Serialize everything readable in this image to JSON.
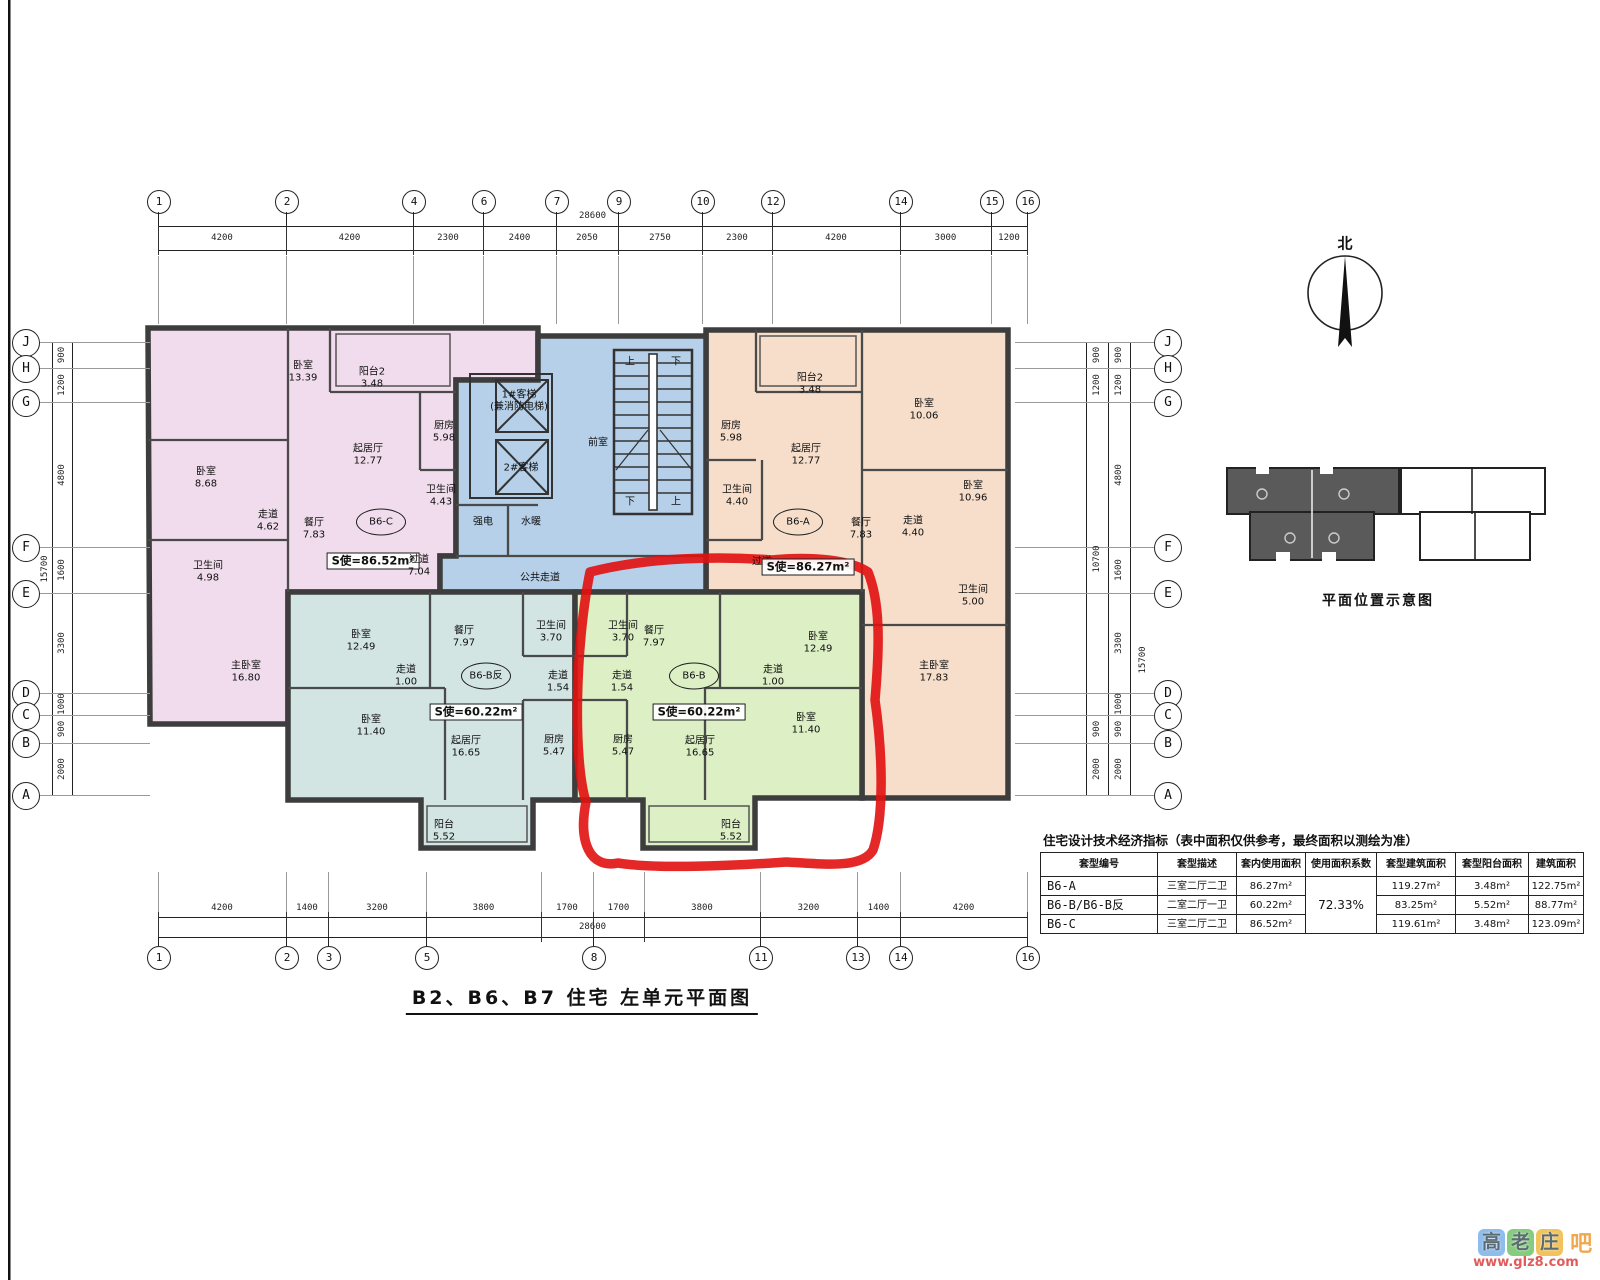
{
  "main_title": {
    "text": "B2、B6、B7 住宅 左单元平面图"
  },
  "north": {
    "label": "北"
  },
  "location": {
    "caption": "平面位置示意图"
  },
  "colors": {
    "unit_b6c_pink": "#f0dcec",
    "unit_b6a_orange": "#f6decb",
    "unit_b6b_mirror_teal": "#d3e5e3",
    "unit_b6b_green": "#dcefc5",
    "core_blue": "#b5d0e8",
    "walls": "#3d3d3d",
    "annotation_red": "#e10f0f"
  },
  "units": [
    {
      "code": "B6-C",
      "fill": "#f0dcec"
    },
    {
      "code": "B6-A",
      "fill": "#f6decb"
    },
    {
      "code": "B6-B反",
      "fill": "#d3e5e3"
    },
    {
      "code": "B6-B",
      "fill": "#dcefc5"
    }
  ],
  "grids": {
    "top": {
      "total": "28600",
      "boundaries": [
        {
          "x": 158,
          "l": "1"
        },
        {
          "x": 286,
          "l": "2"
        },
        {
          "x": 413,
          "l": "4"
        },
        {
          "x": 483,
          "l": "6"
        },
        {
          "x": 556,
          "l": "7"
        },
        {
          "x": 618,
          "l": "9"
        },
        {
          "x": 702,
          "l": "10"
        },
        {
          "x": 772,
          "l": "12"
        },
        {
          "x": 900,
          "l": "14"
        },
        {
          "x": 991,
          "l": "15"
        },
        {
          "x": 1027,
          "l": "16"
        }
      ],
      "segs": [
        "4200",
        "4200",
        "2300",
        "2400",
        "2050",
        "2750",
        "2300",
        "4200",
        "3000",
        "1200"
      ]
    },
    "bottom": {
      "total": "28600",
      "boundaries": [
        {
          "x": 158,
          "l": "1"
        },
        {
          "x": 286,
          "l": "2"
        },
        {
          "x": 328,
          "l": "3"
        },
        {
          "x": 426,
          "l": "5"
        },
        {
          "x": 541
        },
        {
          "x": 593,
          "l": "8"
        },
        {
          "x": 644
        },
        {
          "x": 760,
          "l": "11"
        },
        {
          "x": 857,
          "l": "13"
        },
        {
          "x": 900,
          "l": "14"
        },
        {
          "x": 1027,
          "l": "16"
        }
      ],
      "segs": [
        "4200",
        "1400",
        "3200",
        "3800",
        "1700",
        "1700",
        "3800",
        "3200",
        "1400",
        "4200"
      ]
    },
    "left": {
      "total": "15700",
      "boundaries": [
        {
          "y": 342,
          "l": "J"
        },
        {
          "y": 368,
          "l": "H"
        },
        {
          "y": 402,
          "l": "G"
        },
        {
          "y": 547,
          "l": "F"
        },
        {
          "y": 593,
          "l": "E"
        },
        {
          "y": 693,
          "l": "D"
        },
        {
          "y": 715,
          "l": "C"
        },
        {
          "y": 743,
          "l": "B"
        },
        {
          "y": 795,
          "l": "A"
        }
      ],
      "segs": [
        "900",
        "1200",
        "4800",
        "1600",
        "3300",
        "1000",
        "900",
        "2000"
      ]
    },
    "right": {
      "total": "15700",
      "fine_segs": [
        "900",
        "1200",
        "4800",
        "1600",
        "3300",
        "1000",
        "900",
        "2000"
      ],
      "coarse": {
        "ys": [
          342,
          368,
          402,
          715,
          743,
          795
        ],
        "segs": [
          "900",
          "1200",
          "10700",
          "900",
          "2000"
        ]
      }
    }
  },
  "rooms": [
    {
      "k": "room",
      "t": "卧室",
      "v": "13.39",
      "x": 303,
      "y": 372
    },
    {
      "k": "room",
      "t": "阳台2",
      "v": "3.48",
      "x": 372,
      "y": 378
    },
    {
      "k": "room",
      "t": "厨房",
      "v": "5.98",
      "x": 444,
      "y": 432
    },
    {
      "k": "room",
      "t": "起居厅",
      "v": "12.77",
      "x": 368,
      "y": 455
    },
    {
      "k": "room",
      "t": "卫生间",
      "v": "4.43",
      "x": 441,
      "y": 496
    },
    {
      "k": "room",
      "t": "卧室",
      "v": "8.68",
      "x": 206,
      "y": 478
    },
    {
      "k": "room",
      "t": "走道",
      "v": "4.62",
      "x": 268,
      "y": 521
    },
    {
      "k": "room",
      "t": "餐厅",
      "v": "7.83",
      "x": 314,
      "y": 529
    },
    {
      "k": "bubble",
      "t": "B6-C",
      "x": 381,
      "y": 522
    },
    {
      "k": "sbox",
      "t": "S使=86.52m²",
      "x": 373,
      "y": 561
    },
    {
      "k": "room",
      "t": "过道",
      "v": "7.04",
      "x": 419,
      "y": 566
    },
    {
      "k": "room",
      "t": "卫生间",
      "v": "4.98",
      "x": 208,
      "y": 572
    },
    {
      "k": "room",
      "t": "主卧室",
      "v": "16.80",
      "x": 246,
      "y": 672
    },
    {
      "k": "room",
      "t": "1#客梯",
      "v": "(兼消防电梯)",
      "x": 519,
      "y": 401
    },
    {
      "k": "plain",
      "t": "2#客梯",
      "x": 521,
      "y": 468
    },
    {
      "k": "plain",
      "t": "前室",
      "x": 598,
      "y": 443
    },
    {
      "k": "plain",
      "t": "强电",
      "x": 483,
      "y": 522
    },
    {
      "k": "plain",
      "t": "水暖",
      "x": 531,
      "y": 522
    },
    {
      "k": "plain",
      "t": "公共走道",
      "x": 540,
      "y": 578
    },
    {
      "k": "plain",
      "t": "上",
      "x": 630,
      "y": 362
    },
    {
      "k": "plain",
      "t": "下",
      "x": 676,
      "y": 362
    },
    {
      "k": "plain",
      "t": "下",
      "x": 630,
      "y": 502
    },
    {
      "k": "plain",
      "t": "上",
      "x": 676,
      "y": 502
    },
    {
      "k": "room",
      "t": "阳台2",
      "v": "3.48",
      "x": 810,
      "y": 384
    },
    {
      "k": "room",
      "t": "厨房",
      "v": "5.98",
      "x": 731,
      "y": 432
    },
    {
      "k": "room",
      "t": "起居厅",
      "v": "12.77",
      "x": 806,
      "y": 455
    },
    {
      "k": "room",
      "t": "卧室",
      "v": "10.06",
      "x": 924,
      "y": 410
    },
    {
      "k": "room",
      "t": "卫生间",
      "v": "4.40",
      "x": 737,
      "y": 496
    },
    {
      "k": "bubble",
      "t": "B6-A",
      "x": 798,
      "y": 522
    },
    {
      "k": "room",
      "t": "餐厅",
      "v": "7.83",
      "x": 861,
      "y": 529
    },
    {
      "k": "room",
      "t": "走道",
      "v": "4.40",
      "x": 913,
      "y": 527
    },
    {
      "k": "plain",
      "t": "过道",
      "x": 762,
      "y": 562
    },
    {
      "k": "sbox",
      "t": "S使=86.27m²",
      "x": 808,
      "y": 567
    },
    {
      "k": "room",
      "t": "卧室",
      "v": "10.96",
      "x": 973,
      "y": 492
    },
    {
      "k": "room",
      "t": "卫生间",
      "v": "5.00",
      "x": 973,
      "y": 596
    },
    {
      "k": "room",
      "t": "主卧室",
      "v": "17.83",
      "x": 934,
      "y": 672
    },
    {
      "k": "room",
      "t": "卧室",
      "v": "12.49",
      "x": 361,
      "y": 641
    },
    {
      "k": "room",
      "t": "走道",
      "v": "1.00",
      "x": 406,
      "y": 676
    },
    {
      "k": "room",
      "t": "卧室",
      "v": "11.40",
      "x": 371,
      "y": 726
    },
    {
      "k": "room",
      "t": "餐厅",
      "v": "7.97",
      "x": 464,
      "y": 637
    },
    {
      "k": "room",
      "t": "卫生间",
      "v": "3.70",
      "x": 551,
      "y": 632
    },
    {
      "k": "room",
      "t": "走道",
      "v": "1.54",
      "x": 558,
      "y": 682
    },
    {
      "k": "room",
      "t": "厨房",
      "v": "5.47",
      "x": 554,
      "y": 746
    },
    {
      "k": "room",
      "t": "起居厅",
      "v": "16.65",
      "x": 466,
      "y": 747
    },
    {
      "k": "bubble",
      "t": "B6-B反",
      "x": 486,
      "y": 676
    },
    {
      "k": "sbox",
      "t": "S使=60.22m²",
      "x": 476,
      "y": 712
    },
    {
      "k": "room",
      "t": "阳台",
      "v": "5.52",
      "x": 444,
      "y": 831
    },
    {
      "k": "room",
      "t": "卫生间",
      "v": "3.70",
      "x": 623,
      "y": 632
    },
    {
      "k": "room",
      "t": "走道",
      "v": "1.54",
      "x": 622,
      "y": 682
    },
    {
      "k": "room",
      "t": "餐厅",
      "v": "7.97",
      "x": 654,
      "y": 637
    },
    {
      "k": "room",
      "t": "厨房",
      "v": "5.47",
      "x": 623,
      "y": 746
    },
    {
      "k": "room",
      "t": "起居厅",
      "v": "16.65",
      "x": 700,
      "y": 747
    },
    {
      "k": "bubble",
      "t": "B6-B",
      "x": 694,
      "y": 676
    },
    {
      "k": "sbox",
      "t": "S使=60.22m²",
      "x": 699,
      "y": 712
    },
    {
      "k": "room",
      "t": "卧室",
      "v": "12.49",
      "x": 818,
      "y": 643
    },
    {
      "k": "room",
      "t": "走道",
      "v": "1.00",
      "x": 773,
      "y": 676
    },
    {
      "k": "room",
      "t": "卧室",
      "v": "11.40",
      "x": 806,
      "y": 724
    },
    {
      "k": "room",
      "t": "阳台",
      "v": "5.52",
      "x": 731,
      "y": 831
    }
  ],
  "table": {
    "title": "住宅设计技术经济指标（表中面积仅供参考，最终面积以测绘为准）",
    "headers": [
      "套型编号",
      "套型描述",
      "套内使用面积",
      "使用面积系数",
      "套型建筑面积",
      "套型阳台面积",
      "建筑面积"
    ],
    "usage_ratio": "72.33%",
    "rows": [
      [
        "B6-A",
        "三室二厅二卫",
        "86.27m²",
        "119.27m²",
        "3.48m²",
        "122.75m²"
      ],
      [
        "B6-B/B6-B反",
        "二室二厅一卫",
        "60.22m²",
        "83.25m²",
        "5.52m²",
        "88.77m²"
      ],
      [
        "B6-C",
        "三室二厅二卫",
        "86.52m²",
        "119.61m²",
        "3.48m²",
        "123.09m²"
      ]
    ]
  },
  "watermark": {
    "boxes": [
      {
        "ch": "高",
        "bg": "#8ebcec"
      },
      {
        "ch": "老",
        "bg": "#86cc7e"
      },
      {
        "ch": "庄",
        "bg": "#f2c35c"
      }
    ],
    "suffix": "吧",
    "url": "www.glz8.com"
  }
}
